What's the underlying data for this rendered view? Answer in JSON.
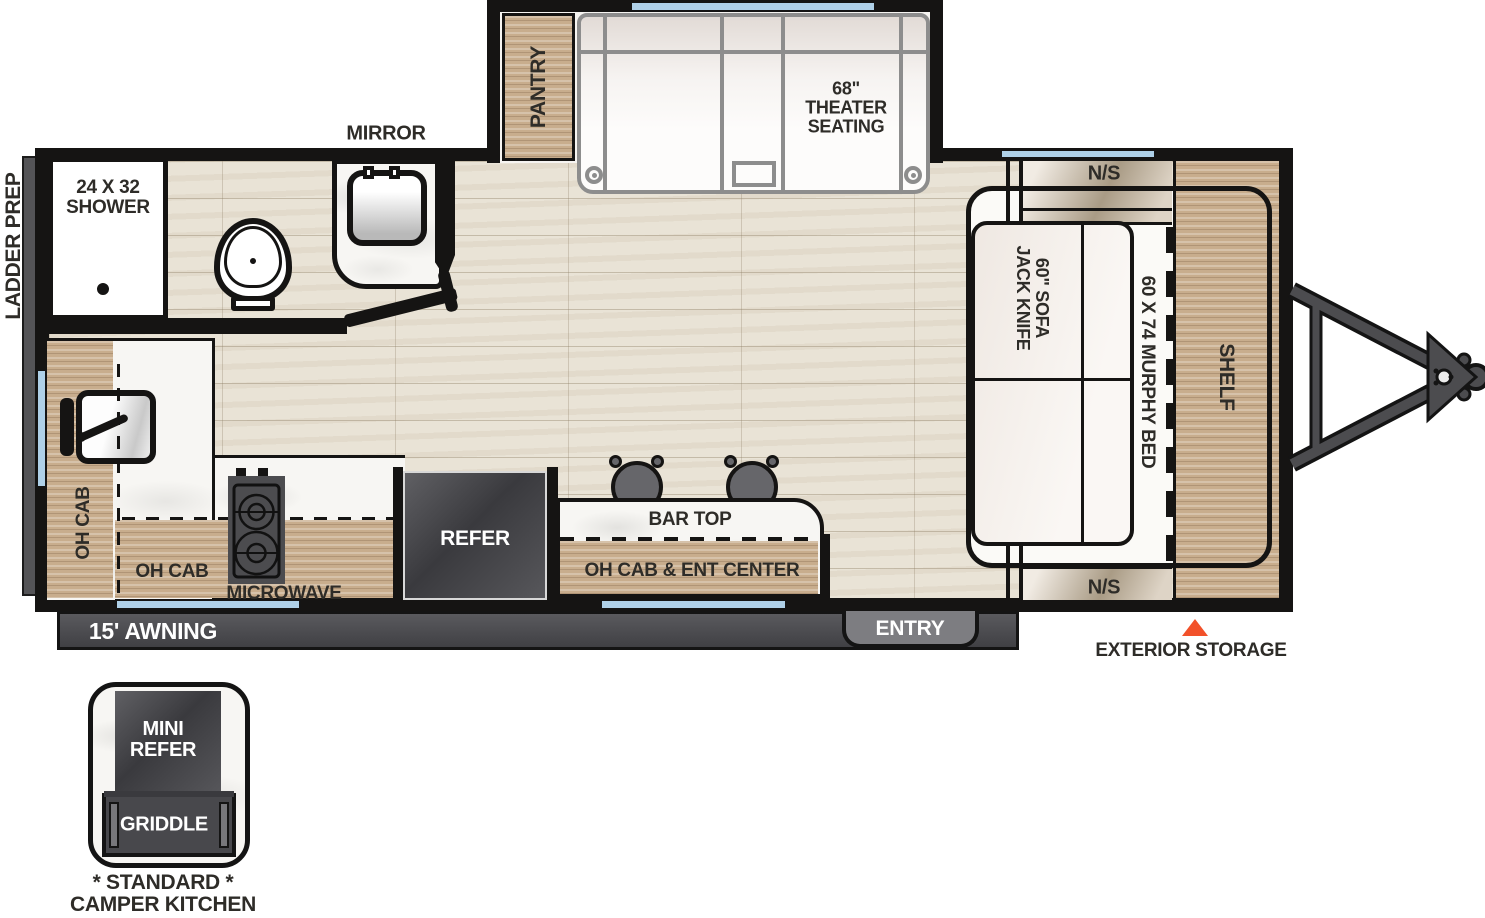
{
  "colors": {
    "wall": "#151413",
    "cabinet_wood": "#c8ad8d",
    "floor": "#e9e3d6",
    "countertop_marble": "#f7f6f3",
    "dark_appliance": "#46464a",
    "window_blue": "#aed0e8",
    "accent_orange": "#f2512a",
    "label_text": "#2e2c28",
    "furniture_outline_gray": "#8d8d8d",
    "badge_gray": "#7d7d81"
  },
  "exterior": {
    "ladder_prep": "LADDER PREP",
    "awning": "15' AWNING",
    "entry": "ENTRY",
    "exterior_storage": "EXTERIOR STORAGE"
  },
  "slideout": {
    "pantry": "PANTRY",
    "theater_seating": "68\"\nTHEATER\nSEATING"
  },
  "bathroom": {
    "mirror": "MIRROR",
    "shower": "24 X 32\nSHOWER"
  },
  "kitchen": {
    "oh_cab_left": "OH CAB",
    "oh_cab_bottom": "OH CAB",
    "microwave": "MICROWAVE",
    "refer": "REFER",
    "bar_top": "BAR TOP",
    "oh_cab_ent_center": "OH CAB & ENT CENTER"
  },
  "bedroom": {
    "ns_front": "N/S",
    "ns_rear": "N/S",
    "sofa": "60\" SOFA\nJACK KNIFE",
    "murphy_bed": "60 X 74 MURPHY BED",
    "shelf": "SHELF"
  },
  "camper_kitchen_inset": {
    "mini_refer": "MINI\nREFER",
    "griddle": "GRIDDLE",
    "caption": "* STANDARD *\nCAMPER KITCHEN"
  }
}
